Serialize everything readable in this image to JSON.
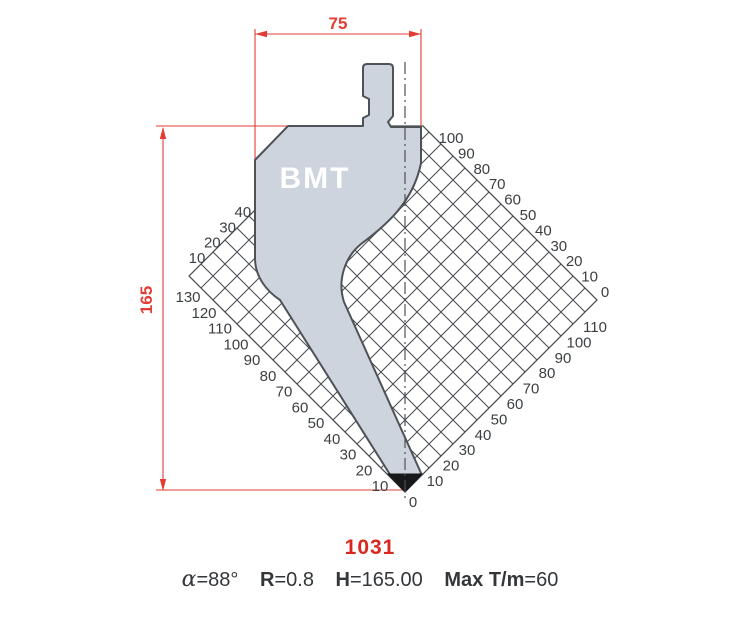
{
  "drawing": {
    "brand": "BMT",
    "dimensions": {
      "width_label": "75",
      "height_label": "165"
    },
    "origin_label": "0",
    "scales": {
      "upper_left": [
        "10",
        "20",
        "30",
        "40"
      ],
      "lower_left": [
        "130",
        "120",
        "110",
        "100",
        "90",
        "80",
        "70",
        "60",
        "50",
        "40",
        "30",
        "20",
        "10"
      ],
      "upper_right": [
        "100",
        "90",
        "80",
        "70",
        "60",
        "50",
        "40",
        "30",
        "20",
        "10",
        "0"
      ],
      "lower_right": [
        "110",
        "100",
        "90",
        "80",
        "70",
        "60",
        "50",
        "40",
        "30",
        "20",
        "10"
      ]
    }
  },
  "footer": {
    "part_number": "1031",
    "specs": [
      {
        "label": "α",
        "value": "=88°"
      },
      {
        "label": "R",
        "value": "=0.8"
      },
      {
        "label": "H",
        "value": "=165.00"
      },
      {
        "label": "Max T/m",
        "value": "=60"
      }
    ]
  },
  "colors": {
    "dimension_red": "#e23c34",
    "part_number_red": "#d9281f",
    "punch_fill": "#cdd4de",
    "outline_gray": "#4d5257",
    "hatch_gray": "#45494d",
    "label_gray": "#3c4043"
  }
}
